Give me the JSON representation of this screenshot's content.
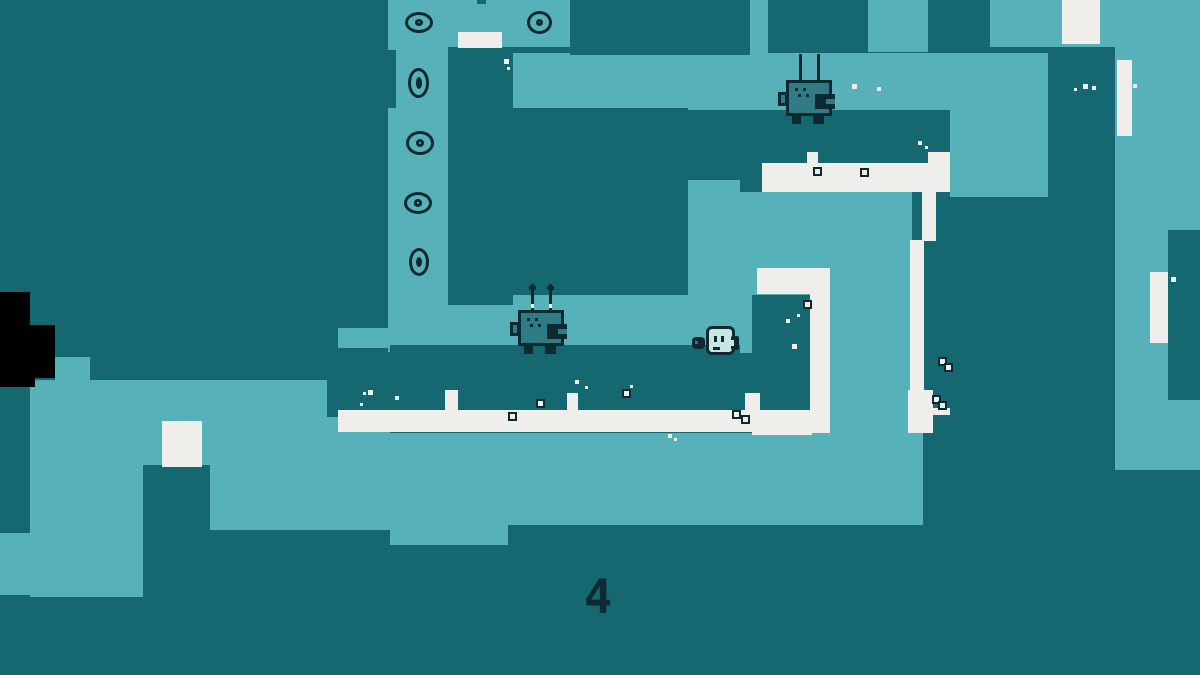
{
  "hud": {
    "counter": "4"
  },
  "palette": {
    "dark_teal": "#156770",
    "light_teal": "#57B1B8",
    "white": "#F0EEEB",
    "ink": "#0D2A33",
    "black": "#000000",
    "robot_fill": "#2F7B86",
    "player_fill": "#CBE6E2"
  },
  "map": {
    "light_rects": [
      [
        388,
        0,
        62,
        352
      ],
      [
        448,
        0,
        122,
        47
      ],
      [
        750,
        0,
        18,
        54
      ],
      [
        868,
        0,
        60,
        52
      ],
      [
        990,
        0,
        58,
        47
      ],
      [
        1048,
        0,
        67,
        47
      ],
      [
        1115,
        0,
        85,
        230
      ],
      [
        1110,
        230,
        58,
        240
      ],
      [
        1110,
        400,
        90,
        70
      ],
      [
        513,
        53,
        535,
        57
      ],
      [
        950,
        110,
        98,
        90
      ],
      [
        740,
        192,
        172,
        241
      ],
      [
        688,
        180,
        52,
        112
      ],
      [
        448,
        290,
        295,
        62
      ],
      [
        30,
        380,
        117,
        217
      ],
      [
        147,
        380,
        243,
        150
      ],
      [
        0,
        533,
        30,
        62
      ],
      [
        55,
        357,
        35,
        29
      ],
      [
        390,
        433,
        118,
        112
      ],
      [
        508,
        433,
        115,
        92
      ],
      [
        623,
        433,
        300,
        92
      ],
      [
        338,
        328,
        52,
        20
      ]
    ],
    "dark_rects": [
      [
        570,
        0,
        180,
        55
      ],
      [
        768,
        0,
        100,
        52
      ],
      [
        928,
        0,
        62,
        53
      ],
      [
        448,
        47,
        65,
        258
      ],
      [
        513,
        108,
        175,
        187
      ],
      [
        688,
        113,
        52,
        67
      ],
      [
        740,
        110,
        22,
        82
      ],
      [
        762,
        110,
        188,
        53
      ],
      [
        935,
        177,
        15,
        20
      ],
      [
        390,
        345,
        350,
        75
      ],
      [
        327,
        380,
        63,
        37
      ],
      [
        752,
        295,
        58,
        115
      ],
      [
        740,
        353,
        12,
        80
      ],
      [
        935,
        197,
        115,
        478
      ],
      [
        1048,
        47,
        67,
        628
      ],
      [
        1168,
        230,
        32,
        170
      ],
      [
        1110,
        470,
        90,
        205
      ],
      [
        923,
        347,
        27,
        86
      ],
      [
        0,
        386,
        30,
        147
      ],
      [
        143,
        465,
        67,
        132
      ],
      [
        388,
        50,
        8,
        58
      ],
      [
        477,
        0,
        9,
        4
      ]
    ],
    "black_rects": [
      [
        0,
        292,
        30,
        34
      ],
      [
        0,
        325,
        55,
        53
      ],
      [
        0,
        378,
        35,
        9
      ]
    ],
    "white_rects": [
      [
        458,
        32,
        44,
        16
      ],
      [
        1062,
        0,
        38,
        44
      ],
      [
        1117,
        60,
        15,
        76
      ],
      [
        1150,
        272,
        18,
        71
      ],
      [
        762,
        163,
        188,
        29
      ],
      [
        807,
        152,
        11,
        12
      ],
      [
        928,
        152,
        22,
        26
      ],
      [
        922,
        177,
        14,
        64
      ],
      [
        910,
        240,
        14,
        152
      ],
      [
        908,
        390,
        25,
        43
      ],
      [
        933,
        408,
        17,
        7
      ],
      [
        757,
        268,
        73,
        26
      ],
      [
        810,
        293,
        20,
        140
      ],
      [
        752,
        410,
        60,
        25
      ],
      [
        338,
        410,
        492,
        22
      ],
      [
        445,
        390,
        13,
        22
      ],
      [
        567,
        393,
        11,
        19
      ],
      [
        745,
        393,
        15,
        19
      ],
      [
        162,
        421,
        40,
        46
      ]
    ]
  },
  "decor": {
    "speckles": [
      [
        504,
        59,
        5
      ],
      [
        507,
        67,
        3
      ],
      [
        852,
        84,
        5
      ],
      [
        824,
        89,
        3
      ],
      [
        877,
        87,
        4
      ],
      [
        1074,
        88,
        3
      ],
      [
        1083,
        84,
        5
      ],
      [
        1092,
        86,
        4
      ],
      [
        1133,
        84,
        4
      ],
      [
        918,
        141,
        4
      ],
      [
        925,
        146,
        3
      ],
      [
        368,
        390,
        5
      ],
      [
        363,
        392,
        3
      ],
      [
        395,
        396,
        4
      ],
      [
        360,
        403,
        3
      ],
      [
        372,
        412,
        4
      ],
      [
        575,
        380,
        4
      ],
      [
        585,
        386,
        3
      ],
      [
        630,
        385,
        3
      ],
      [
        786,
        319,
        4
      ],
      [
        797,
        314,
        3
      ],
      [
        792,
        344,
        5
      ],
      [
        668,
        434,
        4
      ],
      [
        674,
        438,
        3
      ],
      [
        1171,
        277,
        5
      ]
    ],
    "outlined_dots": [
      [
        803,
        300
      ],
      [
        860,
        168
      ],
      [
        813,
        167
      ],
      [
        536,
        399
      ],
      [
        508,
        412
      ],
      [
        622,
        389
      ],
      [
        732,
        410
      ],
      [
        741,
        415
      ],
      [
        938,
        357
      ],
      [
        944,
        363
      ],
      [
        932,
        395
      ],
      [
        938,
        401
      ]
    ]
  },
  "collectibles": {
    "rings": [
      {
        "x": 405,
        "y": 12,
        "w": 28,
        "h": 21
      },
      {
        "x": 408,
        "y": 68,
        "w": 21,
        "h": 30
      },
      {
        "x": 406,
        "y": 131,
        "w": 28,
        "h": 24
      },
      {
        "x": 404,
        "y": 192,
        "w": 28,
        "h": 22
      },
      {
        "x": 409,
        "y": 248,
        "w": 20,
        "h": 28
      },
      {
        "x": 527,
        "y": 11,
        "w": 25,
        "h": 23
      }
    ]
  },
  "entities": {
    "robots": [
      {
        "x": 786,
        "y": 54,
        "tips": false
      },
      {
        "x": 518,
        "y": 284,
        "tips": true
      }
    ],
    "player": {
      "x": 692,
      "y": 326
    }
  }
}
